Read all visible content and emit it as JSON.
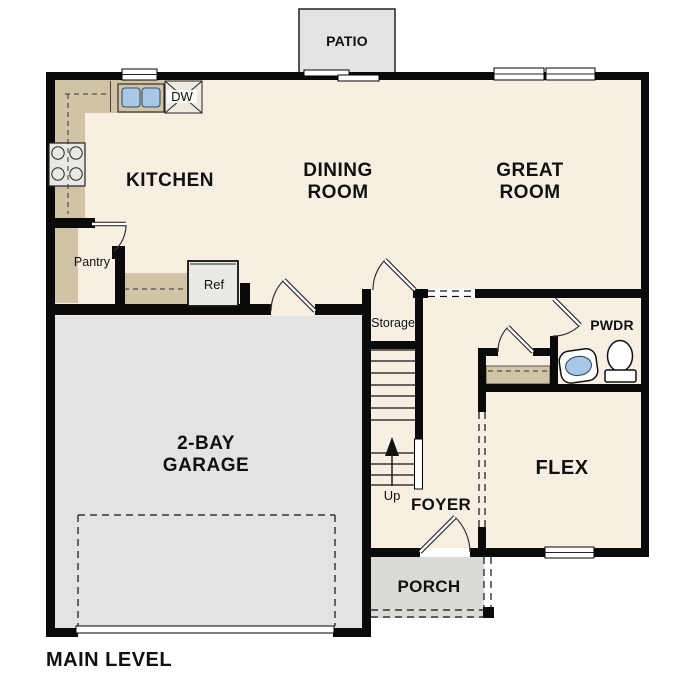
{
  "page": {
    "title": "MAIN LEVEL"
  },
  "rooms": {
    "patio": {
      "label": "PATIO"
    },
    "kitchen": {
      "label": "KITCHEN"
    },
    "dining_room": {
      "lines": [
        "DINING",
        "ROOM"
      ]
    },
    "great_room": {
      "lines": [
        "GREAT",
        "ROOM"
      ]
    },
    "pantry": {
      "label": "Pantry"
    },
    "storage": {
      "label": "Storage"
    },
    "powder_room": {
      "label": "PWDR"
    },
    "garage": {
      "lines": [
        "2-BAY",
        "GARAGE"
      ]
    },
    "flex": {
      "label": "FLEX"
    },
    "foyer": {
      "label": "FOYER"
    },
    "porch": {
      "label": "PORCH"
    }
  },
  "fixtures": {
    "dishwasher_label": "DW",
    "refrigerator_label": "Ref",
    "stairs_up_label": "Up"
  },
  "colors": {
    "wall": "#0a0a0a",
    "floor": "#f7f0e2",
    "garage_floor": "#e5e3e1",
    "porch_floor": "#dcdad7",
    "counter": "#d2c3a7",
    "sink_water": "#a8c8e8"
  }
}
